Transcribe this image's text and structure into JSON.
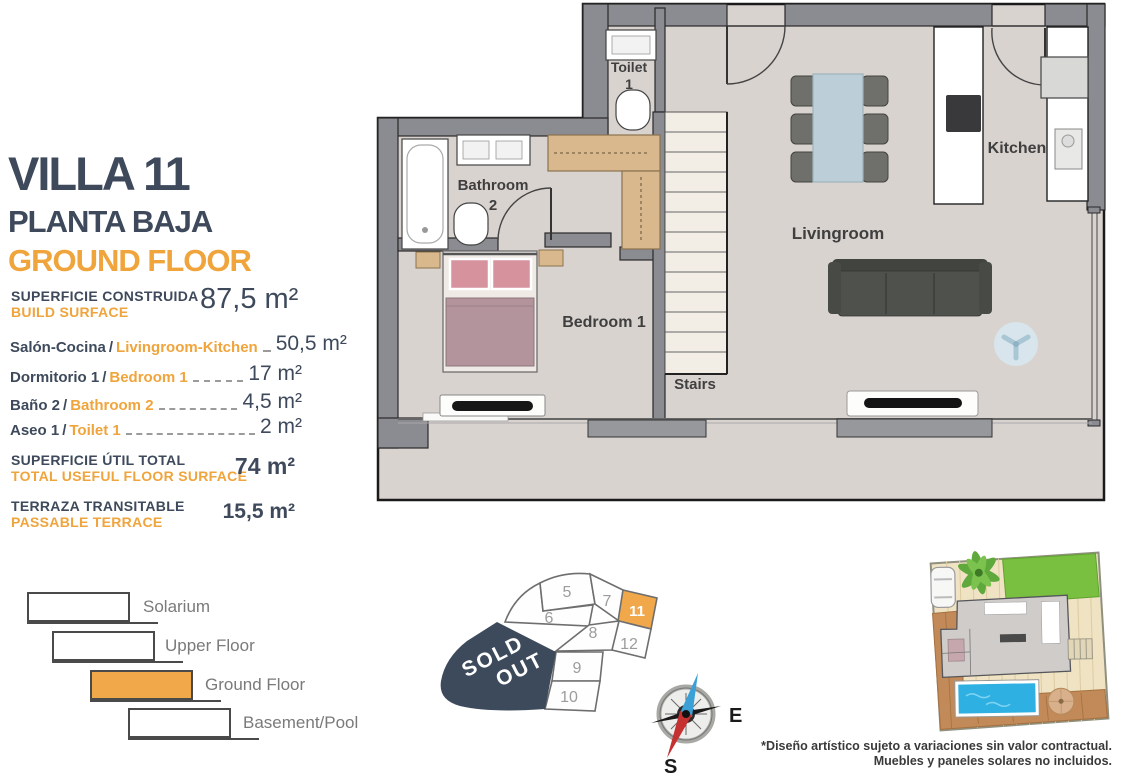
{
  "panel": {
    "title": "VILLA 11",
    "floor_es": "PLANTA BAJA",
    "floor_en": "GROUND FLOOR",
    "sep": "/",
    "build": {
      "es": "SUPERFICIE CONSTRUIDA",
      "en": "BUILD SURFACE",
      "value": "87,5 m²"
    },
    "rooms": [
      {
        "es": "Salón-Cocina",
        "en": "Livingroom-Kitchen",
        "value": "50,5 m²"
      },
      {
        "es": "Dormitorio 1",
        "en": "Bedroom 1",
        "value": "17 m²"
      },
      {
        "es": "Baño 2",
        "en": "Bathroom 2",
        "value": "4,5 m²"
      },
      {
        "es": "Aseo 1",
        "en": "Toilet 1",
        "value": "2 m²"
      }
    ],
    "useful": {
      "es": "SUPERFICIE ÚTIL TOTAL",
      "en": "TOTAL USEFUL FLOOR SURFACE",
      "value": "74 m²"
    },
    "terrace": {
      "es": "TERRAZA TRANSITABLE",
      "en": "PASSABLE TERRACE",
      "value": "15,5 m²"
    }
  },
  "legend": {
    "items": [
      {
        "label": "Solarium"
      },
      {
        "label": "Upper Floor"
      },
      {
        "label": "Ground Floor"
      },
      {
        "label": "Basement/Pool"
      }
    ]
  },
  "plan": {
    "labels": {
      "toilet": "Toilet",
      "toilet_num": "1",
      "bathroom": "Bathroom",
      "bathroom_num": "2",
      "bedroom": "Bedroom 1",
      "stairs": "Stairs",
      "livingroom": "Livingroom",
      "kitchen": "Kitchen"
    }
  },
  "plotmap": {
    "numbers": [
      "5",
      "7",
      "11",
      "6",
      "8",
      "12",
      "9",
      "10"
    ],
    "highlighted": "11",
    "sold_line1": "SOLD",
    "sold_line2": "OUT"
  },
  "compass": {
    "e": "E",
    "s": "S"
  },
  "disclaimer": {
    "line1": "*Diseño artístico sujeto a variaciones sin valor contractual.",
    "line2": "Muebles y paneles solares no incluidos."
  },
  "colors": {
    "navy": "#3E4A5B",
    "orange": "#F0A43C",
    "plot_orange": "#F0A84A",
    "wall": "#8B8B92",
    "floor": "#D9D3D0"
  }
}
